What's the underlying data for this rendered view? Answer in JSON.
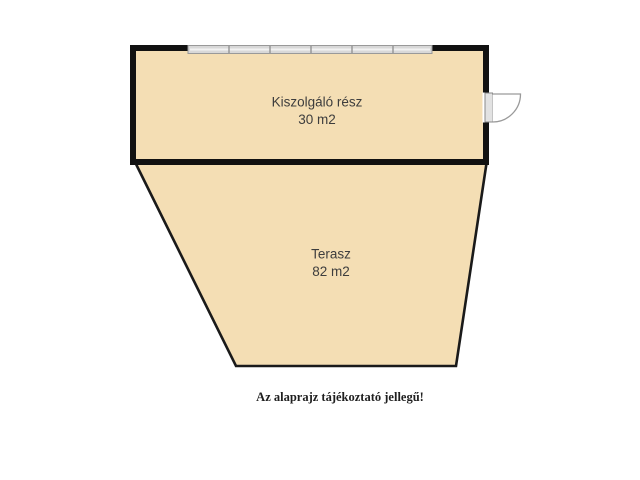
{
  "page": {
    "background": "#ffffff",
    "type": "floor-plan"
  },
  "floor_plan": {
    "rooms": [
      {
        "id": "kiszolgalo",
        "name": "Kiszolgáló rész",
        "area": "30 m2"
      },
      {
        "id": "terasz",
        "name": "Terasz",
        "area": "82 m2"
      }
    ],
    "features": [
      {
        "name": "window",
        "location": "top wall"
      },
      {
        "name": "door-swing",
        "location": "right wall"
      }
    ],
    "caption": "Az alaprajz tájékoztató jellegű!",
    "colors": {
      "room_fill": "#f4deb4",
      "wall": "#111111",
      "terasz_outline": "#1a1a1a",
      "window_fill": "#d8d8d8",
      "window_edge": "#999999",
      "window_highlight": "#f2f2f2",
      "door_stroke": "#9a9a9a",
      "door_jamb_fill": "#e2e2e2",
      "label_text": "#3d3d3d",
      "caption_text": "#1f1f1f"
    }
  }
}
